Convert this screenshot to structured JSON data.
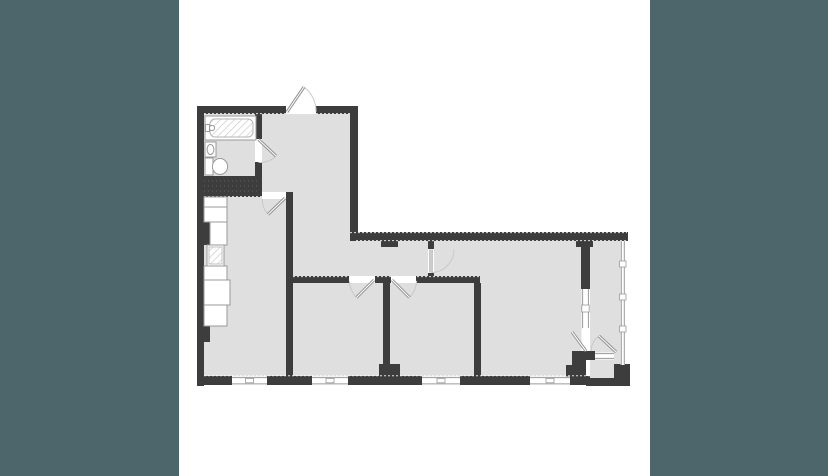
{
  "colors": {
    "background": "#4d666b",
    "card": "#ffffff",
    "wall": "#3d3d3d",
    "floor": "#dfdfdf",
    "outline": "#9a9a9a",
    "door": "#8f8f8f",
    "arc": "#c9c9c9",
    "winline": "#9a9a9a",
    "hatch": "#cccccc"
  },
  "floor_plan": {
    "rooms": [
      "bathroom",
      "entry-hall",
      "kitchen-living-room",
      "corridor",
      "bedroom-1",
      "bedroom-2",
      "living-room",
      "balcony"
    ],
    "fixtures": [
      "bathtub",
      "washbasin",
      "toilet",
      "kitchen-counter",
      "kitchen-sink"
    ],
    "doors": [
      "entry-door",
      "bathroom-door",
      "kitchen-door",
      "bedroom-1-door",
      "bedroom-2-door",
      "living-room-door",
      "balcony-door"
    ],
    "windows": [
      "kitchen-window",
      "bedroom-1-window",
      "bedroom-2-window",
      "living-room-window",
      "living-room-side-window",
      "balcony-glazing"
    ]
  }
}
